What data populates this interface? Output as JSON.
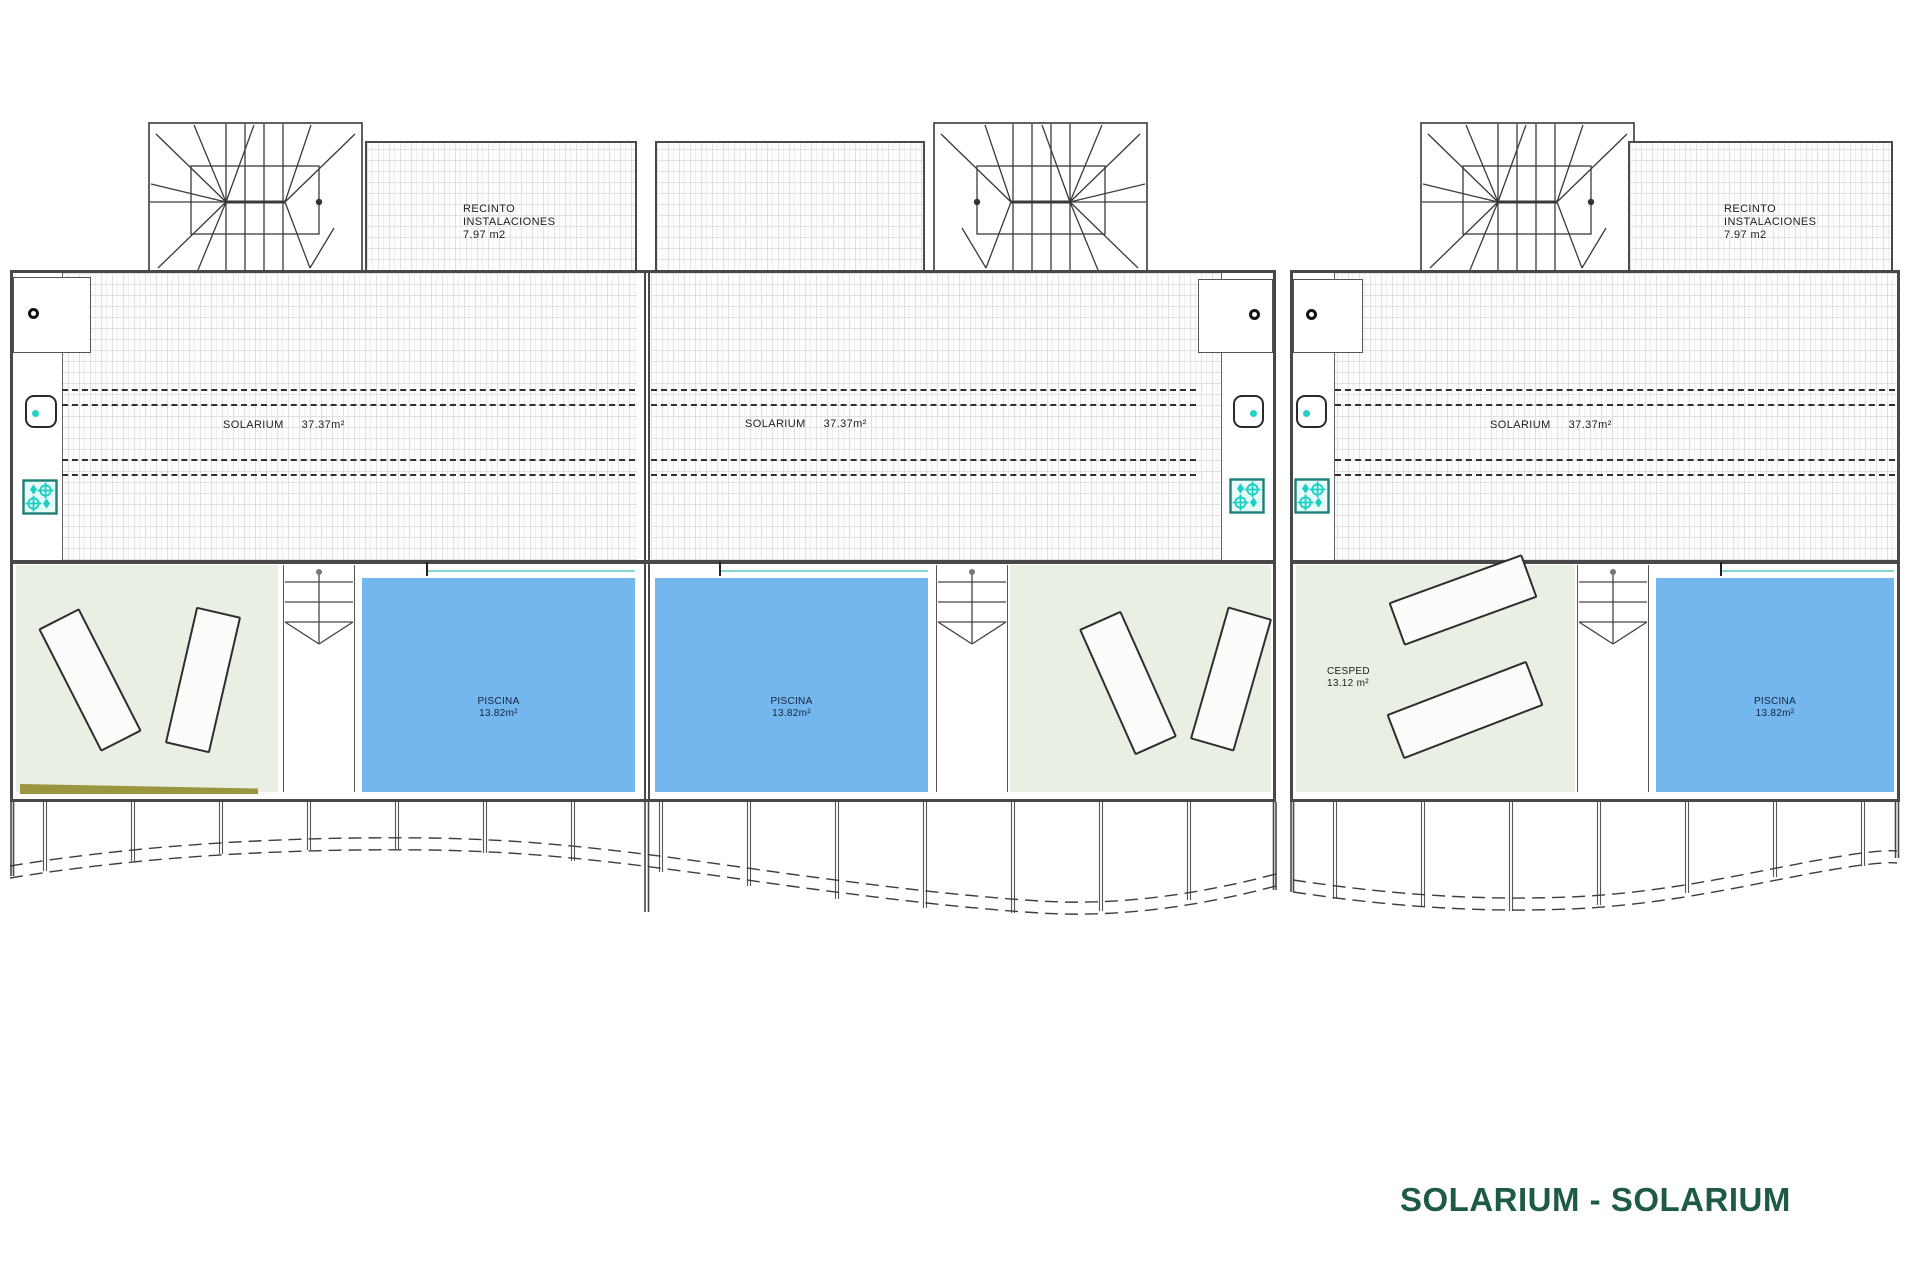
{
  "drawing_title": {
    "text": "SOLARIUM - SOLARIUM",
    "color": "#1e5b44"
  },
  "labels": {
    "recinto": {
      "line1": "RECINTO",
      "line2": "INSTALACIONES",
      "line3": "7.97 m2"
    },
    "solarium": {
      "name": "SOLARIUM",
      "area": "37.37m²"
    },
    "piscina": {
      "name": "PISCINA",
      "area": "13.82m²"
    },
    "cesped": {
      "name": "CESPED",
      "area": "13.12 m²"
    }
  },
  "colors": {
    "pool_water": "#74b7ef",
    "pool_edge_teal": "#85d8d3",
    "lawn_green": "#e9efe3",
    "olive_strip": "#9a9640",
    "stove_teal": "#25d0c7",
    "wall_gray": "#484848",
    "hatch_line": "#e0e0e0",
    "label_ink": "#1d1d1d",
    "title_green": "#1e5b44"
  },
  "icons": {
    "drain": "small-circle-outline",
    "sink": "rounded-square-with-teal-dot",
    "stove": "four-burner-hob",
    "stair_direction": "down-arrow-chevron"
  }
}
